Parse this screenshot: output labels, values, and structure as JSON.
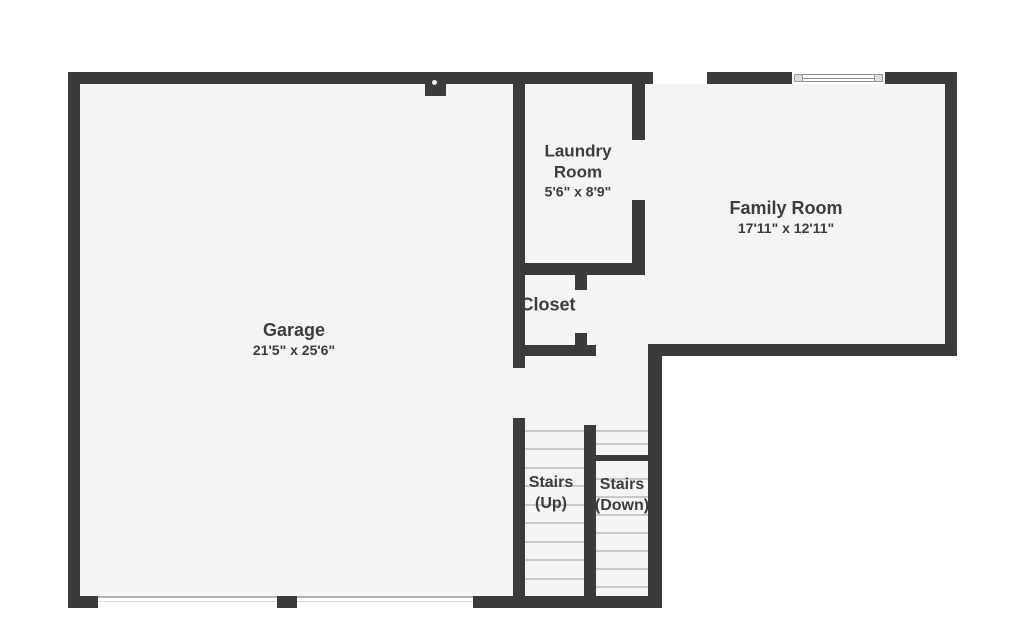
{
  "colors": {
    "wall": "#3b3b3b",
    "floor": "#f5f5f5",
    "background": "#ffffff",
    "label_text": "#3d3d3d"
  },
  "rooms": {
    "garage": {
      "name": "Garage",
      "dims": "21'5\" x 25'6\""
    },
    "laundry": {
      "name": "Laundry Room",
      "dims": "5'6\" x 8'9\""
    },
    "family": {
      "name": "Family Room",
      "dims": "17'11\" x 12'11\""
    },
    "closet": {
      "name": "Closet"
    },
    "stairs_up": {
      "name": "Stairs (Up)"
    },
    "stairs_down": {
      "name": "Stairs (Down)"
    }
  }
}
